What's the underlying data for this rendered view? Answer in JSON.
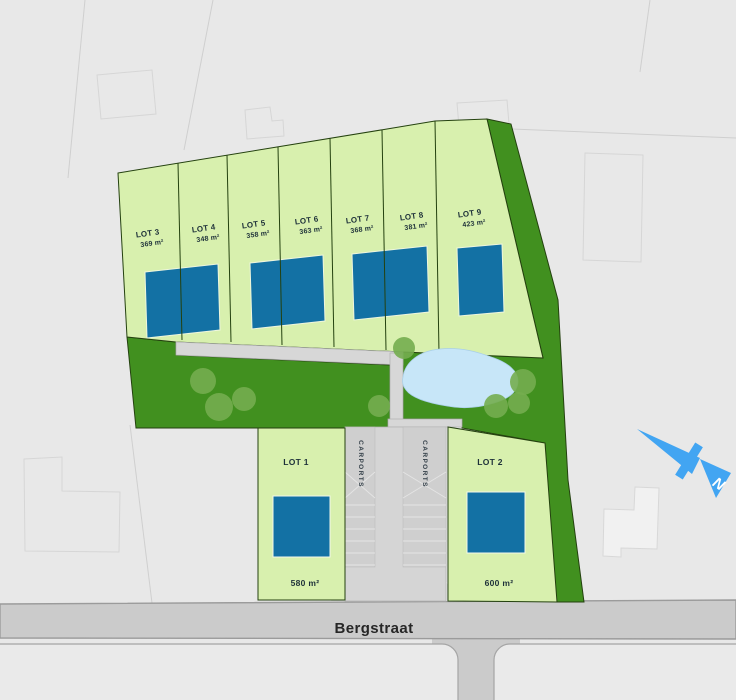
{
  "street": {
    "name": "Bergstraat"
  },
  "compass": {
    "north_label": "N"
  },
  "carports": {
    "left_label": "CARPORTS",
    "right_label": "CARPORTS"
  },
  "lots": {
    "top_row": [
      {
        "label": "LOT 3",
        "area": "369 m²"
      },
      {
        "label": "LOT 4",
        "area": "348 m²"
      },
      {
        "label": "LOT 5",
        "area": "358 m²"
      },
      {
        "label": "LOT 6",
        "area": "363 m²"
      },
      {
        "label": "LOT 7",
        "area": "368 m²"
      },
      {
        "label": "LOT 8",
        "area": "381 m²"
      },
      {
        "label": "LOT 9",
        "area": "423 m²"
      }
    ],
    "bottom_row": [
      {
        "label": "LOT 1",
        "area": "580 m²"
      },
      {
        "label": "LOT 2",
        "area": "600 m²"
      }
    ]
  },
  "colors": {
    "background": "#e8e8e8",
    "lot_fill": "#d8f0ae",
    "garden_green": "#41901f",
    "tree_green": "#74ad4f",
    "house_blue": "#1371a4",
    "pond_blue": "#c7e6f8",
    "road_gray": "#cbcbcb",
    "compass_blue": "#42a5f2"
  }
}
